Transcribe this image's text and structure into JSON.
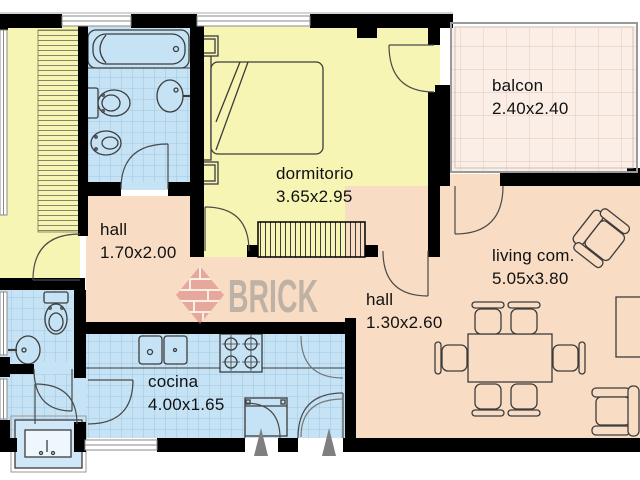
{
  "watermark": {
    "text": "BRICK"
  },
  "colors": {
    "wall": "#000000",
    "room_yellow": "#f6f5b4",
    "room_blue": "#c5e3f5",
    "room_salmon": "#f8dcc3",
    "balcony_pink": "#fbeee7",
    "laundry_blue": "#cfe7f6",
    "grid_blue_line": "#96c0dc",
    "grid_pink_line": "#ddc5b8",
    "stripe_line": "#88876a",
    "fixture_line": "#3c3c3c",
    "door_line": "#4a4a4a",
    "window_line": "#8a8a8a",
    "triangle_gray": "#7f7f7f",
    "watermark_text": "#8f8f8f",
    "watermark_brick": "#d97f7f"
  },
  "rooms": [
    {
      "id": "dormitorio",
      "label": "dormitorio",
      "dims": "3.65x2.95"
    },
    {
      "id": "balcon",
      "label": "balcon",
      "dims": "2.40x2.40"
    },
    {
      "id": "hall_upper",
      "label": "hall",
      "dims": "1.70x2.00"
    },
    {
      "id": "hall_lower",
      "label": "hall",
      "dims": "1.30x2.60"
    },
    {
      "id": "living",
      "label": "living com.",
      "dims": "5.05x3.80"
    },
    {
      "id": "cocina",
      "label": "cocina",
      "dims": "4.00x1.65"
    }
  ]
}
